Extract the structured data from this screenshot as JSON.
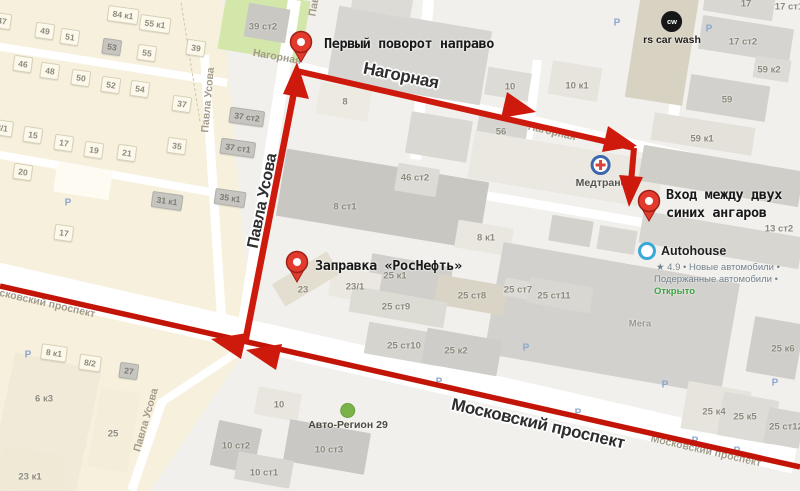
{
  "annotations": {
    "first_turn": "Первый поворот направо",
    "entrance_line1": "Вход между двух",
    "entrance_line2": "синих ангаров",
    "gas_station": "Заправка «РосНефть»"
  },
  "street_labels_big": [
    [
      "Нагорная",
      401,
      76,
      11.5,
      17
    ],
    [
      "Павла Усова",
      263,
      201,
      -78.5,
      16
    ],
    [
      "Московский проспект",
      538,
      424,
      12.8,
      17
    ]
  ],
  "street_labels_ghost": [
    [
      "Нагорная",
      277,
      57,
      10
    ],
    [
      "Нагорная",
      552,
      132,
      13
    ],
    [
      "Павла Усова",
      208,
      100,
      -85
    ],
    [
      "Павла Усова",
      146,
      420,
      -74
    ],
    [
      "Московский проспект",
      40,
      302,
      12.8
    ],
    [
      "Московский проспект",
      706,
      451,
      12.8
    ],
    [
      "Павла Усова",
      318,
      -16,
      -80
    ]
  ],
  "houses": [
    [
      "47",
      2,
      21,
      0
    ],
    [
      "49",
      45,
      31,
      0
    ],
    [
      "51",
      70,
      37,
      0
    ],
    [
      "53",
      112,
      47,
      1
    ],
    [
      "55",
      147,
      53,
      0
    ],
    [
      "84 к1",
      123,
      15,
      0
    ],
    [
      "55 к1",
      155,
      24,
      0
    ],
    [
      "39",
      196,
      48,
      0
    ],
    [
      "46",
      23,
      64,
      0
    ],
    [
      "48",
      50,
      71,
      0
    ],
    [
      "50",
      81,
      78,
      0
    ],
    [
      "52",
      111,
      85,
      0
    ],
    [
      "54",
      140,
      89,
      0
    ],
    [
      "37",
      182,
      104,
      0
    ],
    [
      "3/1",
      2,
      128,
      0
    ],
    [
      "15",
      33,
      135,
      0
    ],
    [
      "17",
      64,
      143,
      0
    ],
    [
      "19",
      94,
      150,
      0
    ],
    [
      "21",
      127,
      153,
      0
    ],
    [
      "35",
      177,
      146,
      0
    ],
    [
      "20",
      23,
      172,
      0
    ],
    [
      "17",
      64,
      233,
      0
    ],
    [
      "31 к1",
      167,
      201,
      1
    ],
    [
      "35 к1",
      230,
      198,
      1
    ],
    [
      "37 ст1",
      238,
      148,
      1
    ],
    [
      "37 ст2",
      247,
      117,
      1
    ],
    [
      "8 к1",
      54,
      353,
      0
    ],
    [
      "8/2",
      90,
      363,
      0
    ],
    [
      "27",
      129,
      371,
      1
    ]
  ],
  "building_labels": [
    [
      "39 ст2",
      263,
      27,
      0
    ],
    [
      "8",
      345,
      102,
      0
    ],
    [
      "10",
      510,
      87,
      0
    ],
    [
      "10 к1",
      577,
      86,
      0
    ],
    [
      "56",
      501,
      132,
      0
    ],
    [
      "8 ст1",
      345,
      207,
      0
    ],
    [
      "46 ст2",
      415,
      178,
      0
    ],
    [
      "17",
      746,
      4,
      0
    ],
    [
      "17 ст1",
      789,
      7,
      0
    ],
    [
      "17 ст2",
      743,
      42,
      0
    ],
    [
      "59 к2",
      769,
      70,
      0
    ],
    [
      "59",
      727,
      100,
      0
    ],
    [
      "59 к1",
      702,
      139,
      0
    ],
    [
      "13 ст2",
      779,
      229,
      0
    ],
    [
      "8 к1",
      486,
      238,
      0
    ],
    [
      "Мега",
      640,
      324,
      1
    ],
    [
      "25 к1",
      395,
      276,
      0
    ],
    [
      "23/1",
      355,
      287,
      0
    ],
    [
      "23",
      303,
      290,
      0
    ],
    [
      "25 ст8",
      472,
      296,
      0
    ],
    [
      "25 ст7",
      518,
      290,
      0
    ],
    [
      "25 ст11",
      554,
      296,
      0
    ],
    [
      "25 ст9",
      396,
      307,
      0
    ],
    [
      "25 ст10",
      404,
      346,
      0
    ],
    [
      "25 к2",
      456,
      351,
      0
    ],
    [
      "25 к6",
      783,
      349,
      0
    ],
    [
      "25 к4",
      714,
      412,
      0
    ],
    [
      "25 к5",
      745,
      417,
      0
    ],
    [
      "25 ст12",
      786,
      427,
      0
    ],
    [
      "10",
      279,
      405,
      0
    ],
    [
      "10 ст2",
      236,
      446,
      0
    ],
    [
      "10 ст3",
      329,
      450,
      0
    ],
    [
      "10 ст1",
      264,
      473,
      0
    ],
    [
      "6 к3",
      44,
      399,
      0
    ],
    [
      "25",
      113,
      434,
      0
    ],
    [
      "23 к1",
      30,
      477,
      0
    ]
  ],
  "parking_label": "Р",
  "parking_positions": [
    [
      617,
      23
    ],
    [
      709,
      29
    ],
    [
      68,
      203
    ],
    [
      28,
      355
    ],
    [
      439,
      382
    ],
    [
      526,
      348
    ],
    [
      578,
      413
    ],
    [
      665,
      385
    ],
    [
      695,
      441
    ],
    [
      737,
      451
    ],
    [
      775,
      383
    ]
  ],
  "pois": {
    "car_wash": {
      "icon_text": "cw",
      "label": "rs car wash"
    },
    "medtrans": {
      "label": "Медтранс"
    },
    "autohouse": {
      "label": "Autohouse",
      "sub1": "★ 4.9 • Новые автомобили •",
      "sub2": "Подержанные автомобили •",
      "status": "Открыто"
    },
    "auto_region": {
      "label": "Авто-Регион 29"
    }
  },
  "colors": {
    "route_red": "#cd1a0d",
    "prospect_red": "#c21508",
    "pin_red": "#e23b2e",
    "pin_border": "#9e1f15",
    "pin_hole": "#ffffff",
    "park_green": "#d3e7ab",
    "residential_beige": "#f6f0dd",
    "open_green": "#3aa23f"
  }
}
